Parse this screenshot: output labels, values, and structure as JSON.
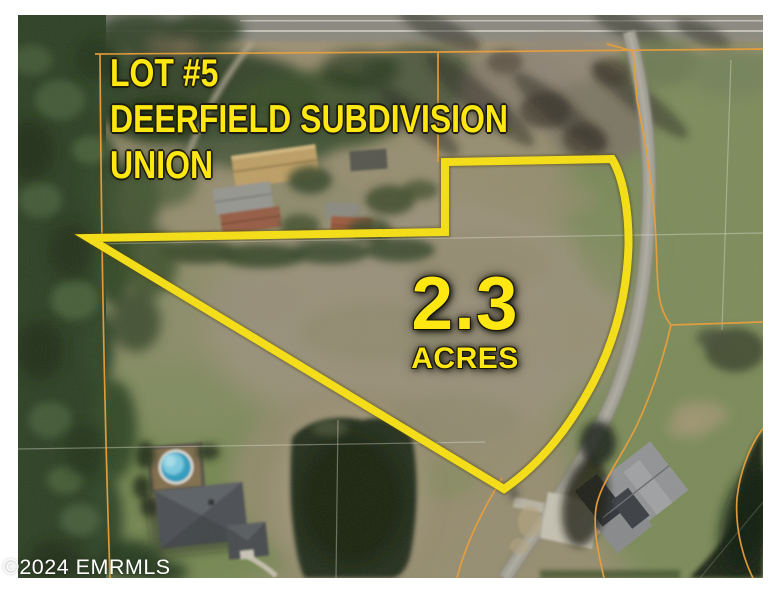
{
  "annotation": {
    "lot_label_line1": "LOT #5",
    "lot_label_line2": "DEERFIELD SUBDIVISION",
    "lot_label_line3": "UNION",
    "acreage_value": "2.3",
    "acreage_unit": "ACRES"
  },
  "watermark": {
    "copyright": "©2024 EMRMLS"
  },
  "colors": {
    "annotation_yellow": "#ffe711",
    "parcel_line_orange": "#f2a236",
    "watermark_white": "#ffffff",
    "border_white": "#ffffff",
    "outline_dark": "#1c1c10"
  },
  "scene": {
    "type": "aerial-photo",
    "features": [
      "highlighted-lot-boundary",
      "parcel-boundary-lines",
      "forest-strip",
      "highway",
      "subdivision-road",
      "farm-buildings",
      "house-with-pool",
      "pond",
      "house-bottom-right"
    ]
  }
}
